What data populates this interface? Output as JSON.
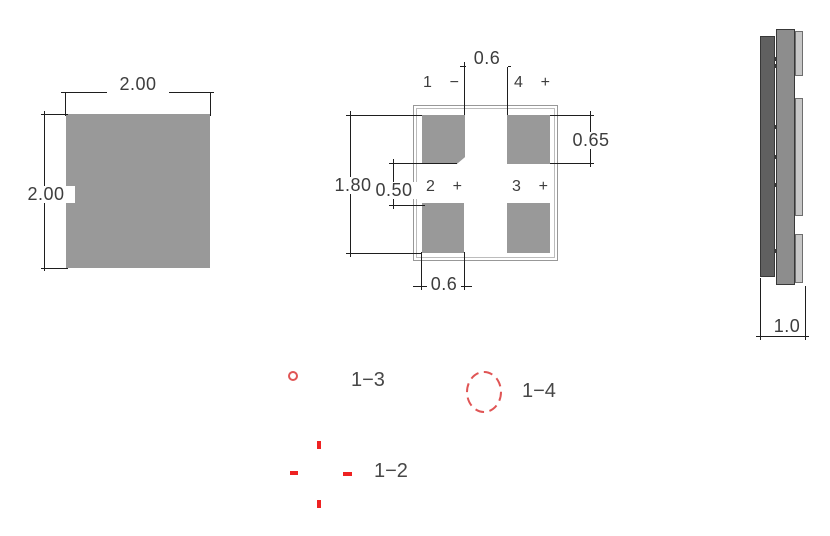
{
  "colors": {
    "pad_gray": "#999999",
    "outline_gray": "#989898",
    "side_dark": "#606060",
    "side_mid": "#8d8d8d",
    "side_tab": "#c6c6c6",
    "dimension_line": "#1e1e1e",
    "text": "#3d3d3d",
    "marking_red": "#e05555"
  },
  "top_view": {
    "dim_width": "2.00",
    "dim_height": "2.00"
  },
  "land_pattern": {
    "dim_center_gap": "0.6",
    "dim_pad_height": "0.65",
    "dim_overall": "1.80",
    "dim_row_gap": "0.50",
    "dim_pad_width": "0.6",
    "pins": [
      {
        "num": "1",
        "sign": "−"
      },
      {
        "num": "4",
        "sign": "+"
      },
      {
        "num": "2",
        "sign": "+"
      },
      {
        "num": "3",
        "sign": "+"
      }
    ]
  },
  "side_view": {
    "dim_thickness": "1.0"
  },
  "markings": {
    "pair_1_3": "1−3",
    "pair_1_4": "1−4",
    "pair_1_2": "1−2"
  }
}
